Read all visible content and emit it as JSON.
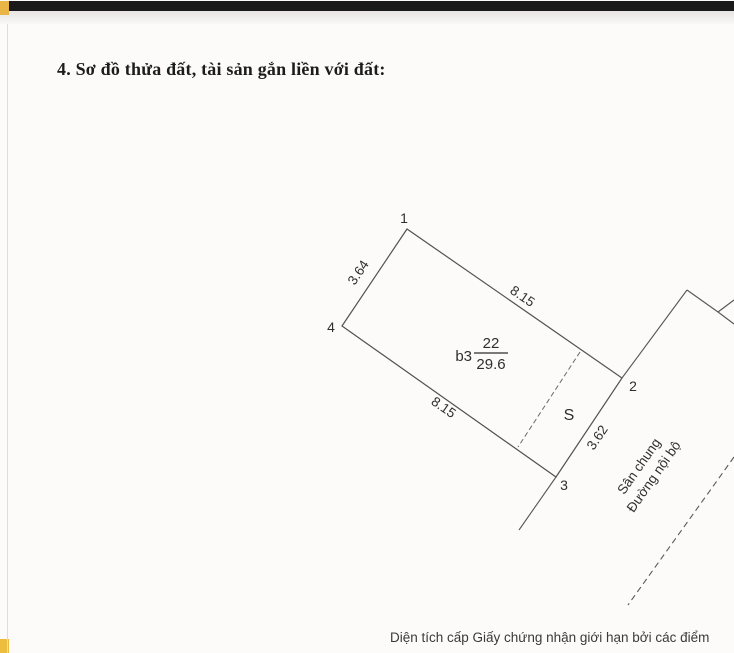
{
  "page": {
    "section_title": "4. Sơ đồ thửa đất, tài sản gắn liền với đất:",
    "footer_note": "Diện tích cấp Giấy chứng nhận giới hạn bởi các điểm"
  },
  "diagram": {
    "vertices": {
      "v1": "1",
      "v2": "2",
      "v3": "3",
      "v4": "4"
    },
    "edges": {
      "top": {
        "length": "8.15"
      },
      "right": {
        "length": "3.62"
      },
      "bottom": {
        "length": "8.15"
      },
      "left": {
        "length": "3.64"
      }
    },
    "parcel": {
      "block": "b3",
      "number": "22",
      "area": "29.6"
    },
    "s_label": "S",
    "road": {
      "line1": "Sân chung",
      "line2": "Đường nội bộ"
    }
  },
  "colors": {
    "corner_mark": "#e9b545",
    "scan_bar": "#1a1a1a",
    "line": "#515151",
    "text": "#2e2e2e"
  }
}
